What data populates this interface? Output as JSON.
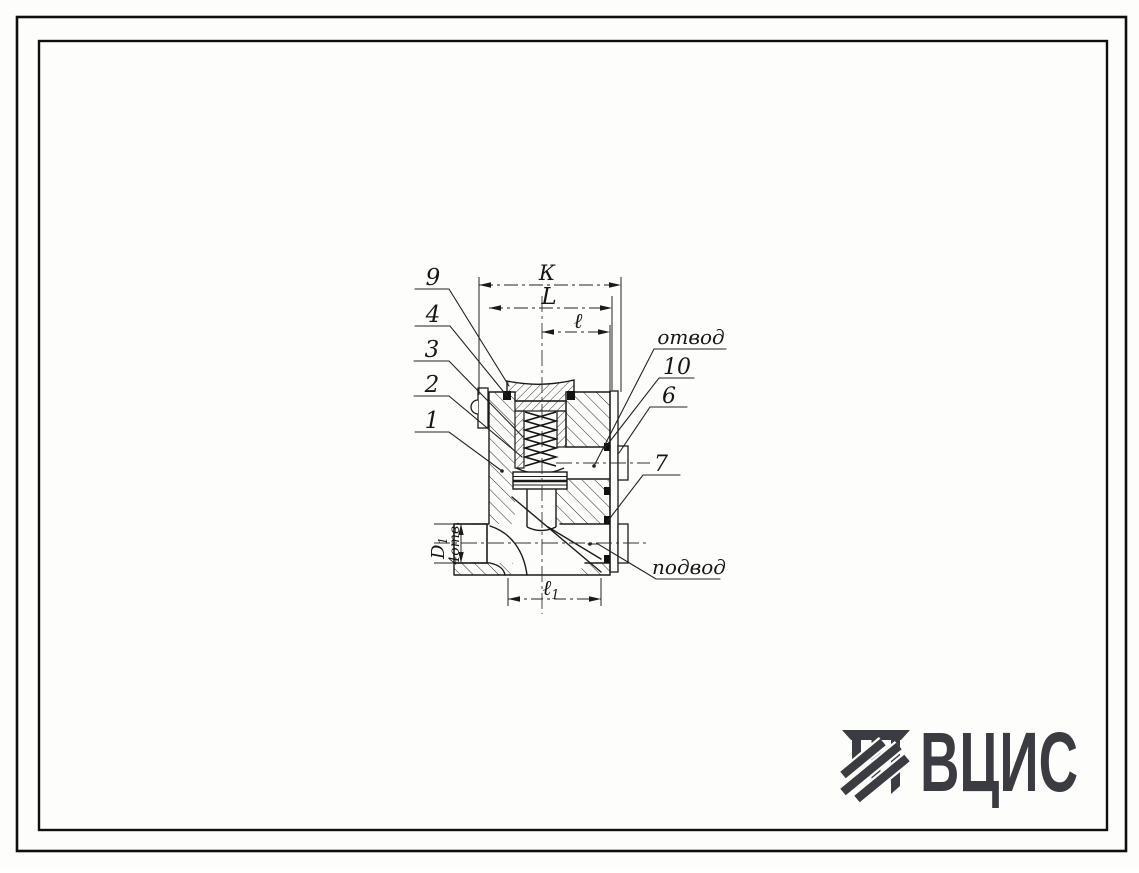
{
  "sheet": {
    "background": "#fdfdfb",
    "border_color": "#0f0f0f"
  },
  "drawing": {
    "kind": "valve cross-section",
    "callouts_left": [
      {
        "label": "9"
      },
      {
        "label": "4"
      },
      {
        "label": "3"
      },
      {
        "label": "2"
      },
      {
        "label": "1"
      }
    ],
    "callouts_right": [
      {
        "label": "отвод"
      },
      {
        "label": "10"
      },
      {
        "label": "6"
      },
      {
        "label": "7"
      },
      {
        "label": "подвод"
      }
    ],
    "dimensions": {
      "k": "К",
      "L": "L",
      "l": "ℓ",
      "l1_main": "ℓ",
      "l1_sub": "1",
      "d1_main": "D",
      "d1_sub": "1",
      "holes": "4отв."
    }
  },
  "logo": {
    "text": "ВЦИС",
    "color": "#3b3b42"
  }
}
